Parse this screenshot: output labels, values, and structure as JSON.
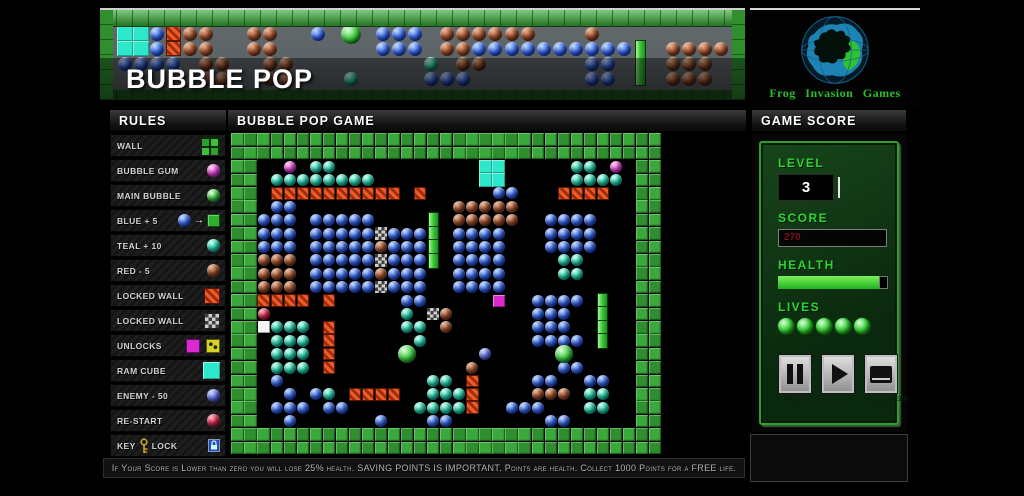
{
  "banner": {
    "title": "BUBBLE POP",
    "rows": [
      ".ccbonn..nn..b.M.bbb.nnnnnn...n.........",
      ".ccbonn..nn......bbb.nnbbbbbbbbbbv.nnnn.",
      ".bbbb.nn..nn........t.nn......bb...nnn..",
      "......nn..nn...t....bbb.......bb...nnn.."
    ]
  },
  "logo": {
    "text": "Frog Invasion Games"
  },
  "sidebar": {
    "title": "RULES",
    "items": [
      {
        "label": "WALL",
        "icon": "wall"
      },
      {
        "label": "BUBBLE GUM",
        "icon": "orb-pink"
      },
      {
        "label": "MAIN BUBBLE",
        "icon": "orb-green"
      },
      {
        "label": "BLUE + 5",
        "icon": "blue-plus"
      },
      {
        "label": "TEAL + 10",
        "icon": "orb-teal"
      },
      {
        "label": "RED  -  5",
        "icon": "orb-red"
      },
      {
        "label": "LOCKED WALL",
        "icon": "lock-orange"
      },
      {
        "label": "LOCKED WALL",
        "icon": "lock-gray"
      },
      {
        "label": "UNLOCKS",
        "icon": "unlocks"
      },
      {
        "label": "RAM CUBE",
        "icon": "ram-cube"
      },
      {
        "label": "ENEMY - 50",
        "icon": "orb-enemy"
      },
      {
        "label": "RE-START",
        "icon": "orb-crimson"
      },
      {
        "label": "KEY",
        "label2": "LOCK",
        "icon": "key-lock"
      }
    ]
  },
  "icons": {
    "arrow_right": "→"
  },
  "main": {
    "title": "BUBBLE POP GAME",
    "legend": {
      "G": "green wall tile",
      "b": "blue bubble +5",
      "t": "teal bubble +10",
      "n": "red bubble -5",
      "o": "locked wall",
      "x": "locked steel wall",
      "m": "bubble gum",
      "M": "main bubble",
      "r": "re-start bubble",
      "e": "enemy bubble -50",
      "w": "white tile",
      "c": "ram cube",
      "p": "unlock square",
      "v": "green bar"
    },
    "board_rows": [
      "GGGGGGGGGGGGGGGGGGGGGGGGGGGGGGGGG",
      "GGGGGGGGGGGGGGGGGGGGGGGGGGGGGGGGG",
      "GG..m.tt...........cc.....tt.m.GG",
      "GG.tttttttt........cc.....tttt.GG",
      "GG.oooooooooo.o.....bb...oooo..GG",
      "GG.bb............nnnnn.........GG",
      "GGbbb.bbbbb....v.nnnnn..bbbb...GG",
      "GGbbb.bbbbbxbbbv.bbbb...bbbb...GG",
      "GGbbb.bbbbbnbbbv.bbbb...bbbb...GG",
      "GGnnn.bbbbbxbbbv.bbbb....tt....GG",
      "GGnnn.bbbbbnbbb..bbbb....tt....GG",
      "GGnnn.bbbbbxbbb..bbbb..........GG",
      "GGoooo.o.....bb.....p..bbbb.v..GG",
      "GGr..........t.xn......bbb..v..GG",
      "GGwttt.o.....tt.n......bbb..v..GG",
      "GG.ttt.o......t........bbbb.v..GG",
      "GG.ttt.o.....M.....e.....M.....GG",
      "GG.ttt.o..........n......bb....GG",
      "GG.b...........tt.o....bb..bb..GG",
      "GG..b.bt.oooo..ttto....nnn.tt..GG",
      "GG.bbb.bb.....tttto..bbb...tt..GG",
      "GG..b......b...bb.......bb.....GG",
      "GGGGGGGGGGGGGGGGGGGGGGGGGGGGGGGGG",
      "GGGGGGGGGGGGGGGGGGGGGGGGGGGGGGGGG"
    ]
  },
  "score_panel": {
    "title": "GAME SCORE",
    "level_label": "LEVEL",
    "level_value": "3",
    "score_label": "SCORE",
    "score_value": "270",
    "health_label": "HEALTH",
    "health_percent": 92,
    "lives_label": "LIVES",
    "lives_count": 5,
    "buttons": [
      {
        "label": "PAUSE",
        "icon": "pause-icon"
      },
      {
        "label": "PLAY",
        "icon": "play-icon"
      },
      {
        "label": "FULLSCREEN",
        "icon": "fullscreen-icon"
      }
    ]
  },
  "footer": {
    "hint": "If Your Score is Lower than zero you will lose 25% health. SAVING POINTS IS IMPORTANT.  Points are health. Collect 1000 Points for a FREE life."
  },
  "colors": {
    "accent_green": "#2fd334",
    "score_red": "#7a1212",
    "wall_green": "#3aa83a",
    "blue_bubble": "#3a6ae8",
    "teal_bubble": "#2ad8b0",
    "red_bubble": "#a05028",
    "locked_wall_orange": "#ef5a26",
    "bubble_gum_pink": "#e84ad0",
    "ram_cube_teal": "#2ee8cc"
  }
}
